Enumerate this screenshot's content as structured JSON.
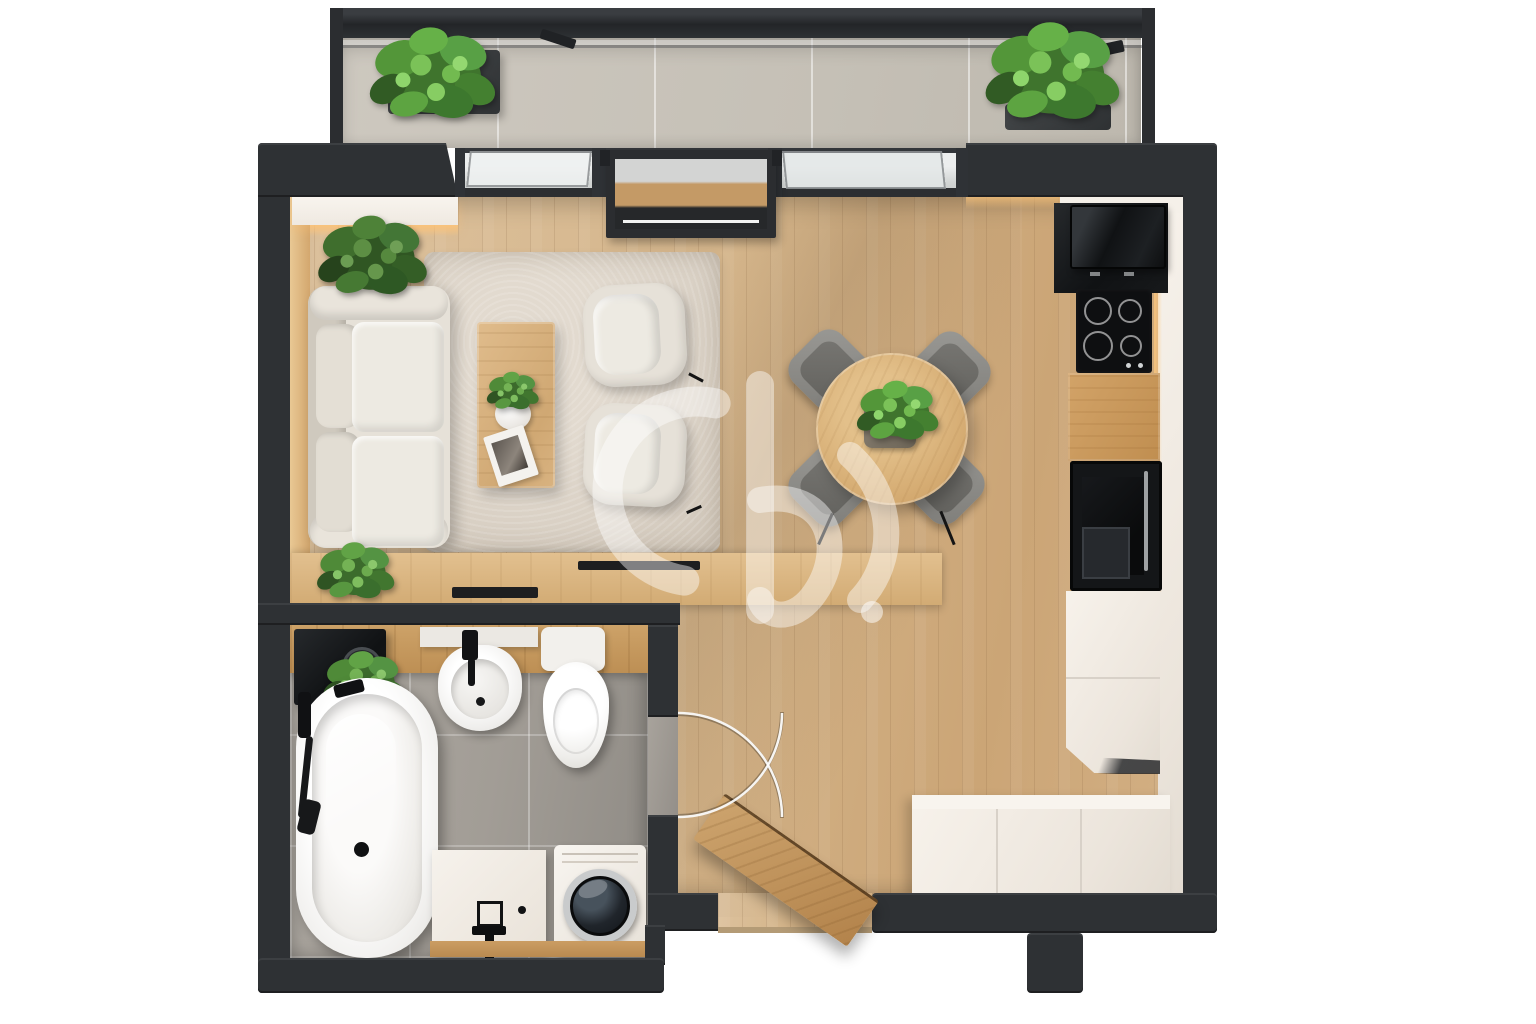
{
  "scene": {
    "type": "3d-floor-plan-top-view",
    "description": "Photorealistic top-down 3D render of a studio apartment floor plan with balcony, living room, dining area, kitchen, bathroom and entry hall. No text is visible in the image.",
    "background": "#ffffff",
    "watermark": "semi-transparent white D-monogram logo with dot, centered over the floor"
  },
  "palette": {
    "wall": "#2e3134",
    "wallDeep": "#1c1e20",
    "wallHi": "#44474b",
    "woodFloor": "#d9bd96",
    "woodFloorDeep": "#c7a171",
    "balconyTile": "#c9c4ba",
    "bathTile": "#a6a19a",
    "bathTileDeep": "#8f8b85",
    "rug": "#dcd3c7",
    "sofa": "#e6e1d8",
    "sofaDeep": "#cfc9be",
    "cushion": "#edeae2",
    "woodFurniture": "#d9b383",
    "oakCounter": "#c9985c",
    "oakDoor": "#c19a65",
    "cabinetWhite": "#f1ebe3",
    "cabinetSeam": "#d8d1c8",
    "applianceBlack": "#17191b",
    "applianceDeep": "#0c0d0e",
    "chairGrey": "#8e8d89",
    "chairSeat": "#6e6d69",
    "plantDark": "#2f5423",
    "plantMid": "#4f8a38",
    "plantLight": "#74b355",
    "glow": "#ffc87e",
    "glass": "#d2d5d4",
    "glassBright": "#eef0f0",
    "watermark": "rgba(255,255,255,0.44)",
    "threshold": "#b49b76",
    "chrome": "#c9cbcc"
  },
  "rooms": [
    {
      "name": "balcony",
      "position": "top",
      "floor": "large grey ceramic tiles",
      "items": [
        "glass-railing-frame",
        "planter-box-left",
        "planter-box-right",
        "green-plants"
      ]
    },
    {
      "name": "living-room",
      "position": "upper-left",
      "floor": "light oak planks",
      "items": [
        "two-seat-sofa",
        "armchair",
        "armchair",
        "coffee-table",
        "potted-plant-on-table",
        "magazine",
        "shag-rug",
        "corner-plant",
        "media-console",
        "console-plant",
        "wall-wash-led-lighting"
      ]
    },
    {
      "name": "dining-area",
      "position": "center-right",
      "floor": "light oak planks",
      "items": [
        "round-wood-table",
        "plant-centerpiece",
        "grey-chair",
        "grey-chair",
        "grey-chair",
        "grey-chair"
      ],
      "chair_count": 4
    },
    {
      "name": "kitchen",
      "position": "right-wall",
      "floor": "light oak planks",
      "items": [
        "black-microwave",
        "induction-cooktop-4-burners",
        "oak-countertop",
        "built-in-black-oven",
        "white-tall-cabinets",
        "under-cabinet-led",
        "white-sideboard"
      ],
      "burner_count": 4
    },
    {
      "name": "bathroom",
      "position": "lower-left",
      "floor": "grey stone tiles",
      "items": [
        "freestanding-bathtub",
        "black-shower-fixtures",
        "wash-basin",
        "black-faucet",
        "wall-hung-toilet",
        "oak-vanity-counter",
        "black-boiler-cabinet",
        "hanging-plant",
        "white-storage-cabinet",
        "washing-machine",
        "swing-door-arcs"
      ]
    },
    {
      "name": "entry-hall",
      "position": "bottom-center",
      "floor": "light oak planks",
      "items": [
        "open-wooden-entry-door",
        "threshold",
        "door-swing-arcs"
      ]
    }
  ],
  "architecture": {
    "walls": "thick matte black partition walls",
    "glazing": "full-width sliding glass doors between living room and balcony, one panel open",
    "entry": "door opening in bottom wall with wooden door leaf shown ajar"
  }
}
